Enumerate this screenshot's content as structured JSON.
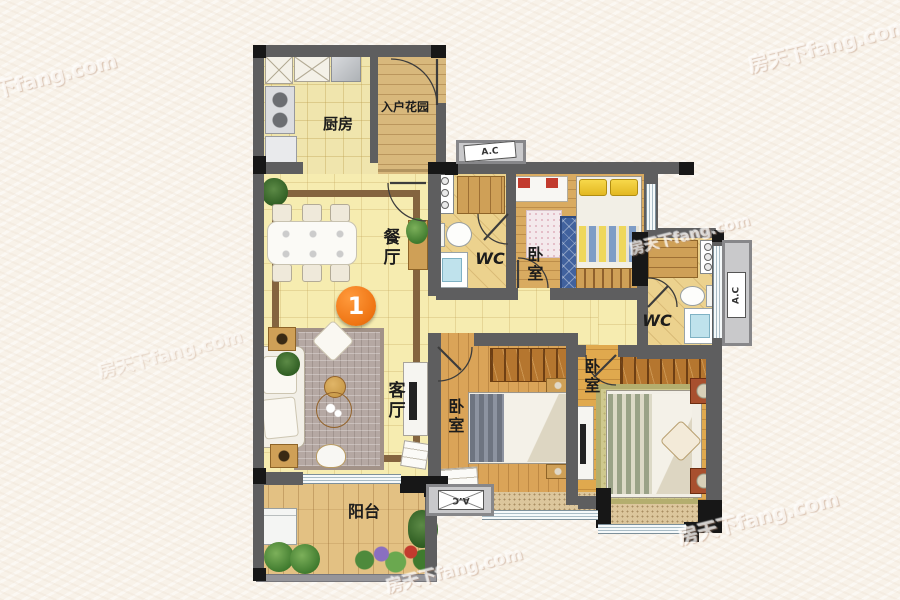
{
  "floorplan": {
    "marker": {
      "number": "1"
    },
    "watermark": "房天下fang.com",
    "rooms": {
      "kitchen": {
        "label": "厨房"
      },
      "entry_garden": {
        "label": "入户花园"
      },
      "dining": {
        "label": "餐厅"
      },
      "living": {
        "label": "客厅"
      },
      "balcony": {
        "label": "阳台"
      },
      "bedroom_top": {
        "label": "卧室"
      },
      "bedroom_middle": {
        "label": "卧室"
      },
      "bedroom_master": {
        "label": "卧室"
      },
      "wc_top": {
        "label": "WC"
      },
      "wc_side": {
        "label": "WC"
      }
    },
    "ac_platform": {
      "label": "A.C",
      "count": 3
    },
    "colors": {
      "background": "#f8f2e9",
      "wall_gray": "#5e5e5f",
      "wall_black": "#171717",
      "tile_floor": "#f6ecb0",
      "wood_floor": "#daa458",
      "entry_wood": "#d8b87c",
      "wc_floor": "#ecd28e",
      "window": "#dfe9ee",
      "marker_orange": "#ef7514",
      "pillow_yellow": "#f0d040",
      "rug_blue": "#41629e"
    }
  }
}
